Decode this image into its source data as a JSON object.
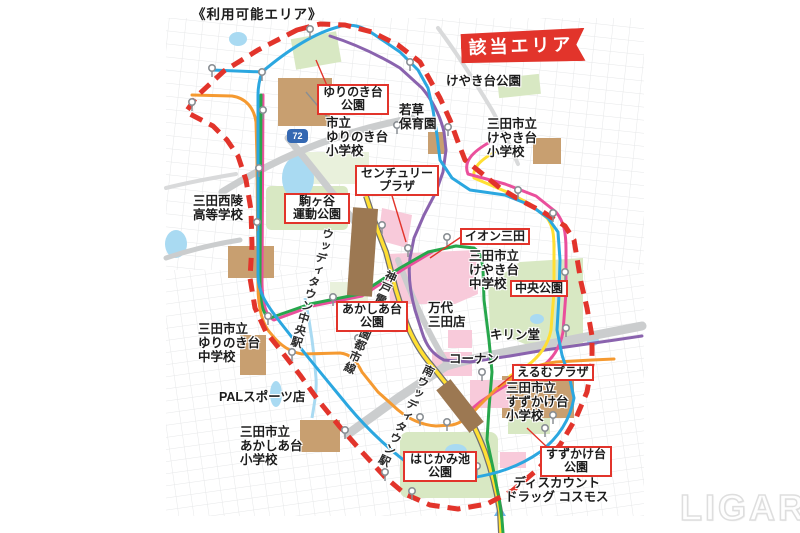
{
  "page": {
    "title": "《利用可能エリア》",
    "banner": "該当エリア",
    "watermark": "LIGARE"
  },
  "map": {
    "road_shield": "72",
    "colors": {
      "red": "#e2342b",
      "blue": "#2ba7e0",
      "green": "#27a74c",
      "orange": "#f59a31",
      "magenta": "#ea4f9c",
      "purple": "#8a63ae",
      "yellow": "#ffdf33",
      "railcase": "#707070",
      "road": "#cbcdce",
      "roadlight": "#d9dadb",
      "park": "#d8e8c3",
      "parkpale": "#e9f1dc",
      "water": "#a9daf2",
      "building": "#c89f70",
      "commercial": "#f8cada",
      "station": "#9c7852",
      "grid": "#e6e7e8"
    },
    "labels": [
      {
        "name": "label-keyakidai-park",
        "text": "けやき台公園",
        "x": 446,
        "y": 74
      },
      {
        "name": "label-wakakusa-nursery",
        "text": "若草\n保育園",
        "x": 399,
        "y": 103
      },
      {
        "name": "label-shiritsu-yurinokidai-elementary",
        "text": "市立\nゆりのき台\n小学校",
        "x": 326,
        "y": 116
      },
      {
        "name": "label-sanda-keyakidai-elementary",
        "text": "三田市立\nけやき台\n小学校",
        "x": 487,
        "y": 117
      },
      {
        "name": "label-sanda-seiryo-highschool",
        "text": "三田西陵\n高等学校",
        "x": 193,
        "y": 194
      },
      {
        "name": "label-sanda-keyakidai-junior-high",
        "text": "三田市立\nけやき台\n中学校",
        "x": 469,
        "y": 249
      },
      {
        "name": "label-mandai-sanda-store",
        "text": "万代\n三田店",
        "x": 428,
        "y": 301
      },
      {
        "name": "label-kirindo",
        "text": "キリン堂",
        "x": 490,
        "y": 328
      },
      {
        "name": "label-kohnan",
        "text": "コーナン",
        "x": 449,
        "y": 352
      },
      {
        "name": "label-sanda-yurinokidai-junior-high",
        "text": "三田市立\nゆりのき台\n中学校",
        "x": 198,
        "y": 322
      },
      {
        "name": "label-pal-sports-store",
        "text": "PALスポーツ店",
        "x": 219,
        "y": 390
      },
      {
        "name": "label-sanda-suzukakedai-elementary",
        "text": "三田市立\nすずかけ台\n小学校",
        "x": 506,
        "y": 381
      },
      {
        "name": "label-sanda-akashiadai-elementary",
        "text": "三田市立\nあかしあ台\n小学校",
        "x": 240,
        "y": 425
      },
      {
        "name": "label-discount-drug-cosmos",
        "text": "ディスカウント\nドラッグ コスモス",
        "x": 505,
        "y": 476,
        "align": "center"
      },
      {
        "name": "label-woodytown-chuo-station",
        "kind": "vert",
        "text": "ウッディタウン中央駅",
        "x": 322,
        "y": 226,
        "rotate": 16,
        "size": 11.5
      },
      {
        "name": "label-kobe-dentetsu-koen-toshi-line",
        "kind": "vert",
        "text": "神戸電鉄公園都市線",
        "x": 386,
        "y": 268,
        "rotate": 24,
        "size": 11.5
      },
      {
        "name": "label-minami-woodytown-station",
        "kind": "vert",
        "text": "南ウッディタウン駅",
        "x": 424,
        "y": 362,
        "rotate": 26,
        "size": 11.5
      },
      {
        "name": "callout-yurinokidai-park",
        "kind": "boxed",
        "text": "ゆりのき台\n公園",
        "x": 317,
        "y": 84,
        "w": 62
      },
      {
        "name": "callout-century-plaza",
        "kind": "boxed",
        "text": "センチュリー\nプラザ",
        "x": 355,
        "y": 165,
        "w": 74
      },
      {
        "name": "callout-komagatani-sports-park",
        "kind": "boxed",
        "text": "駒ヶ谷\n運動公園",
        "x": 284,
        "y": 193,
        "w": 56
      },
      {
        "name": "callout-aeon-sanda",
        "kind": "boxed",
        "text": "イオン三田",
        "x": 460,
        "y": 228
      },
      {
        "name": "callout-chuo-park",
        "kind": "boxed",
        "text": "中央公園",
        "x": 510,
        "y": 280
      },
      {
        "name": "callout-akashiadai-park",
        "kind": "boxed",
        "text": "あかしあ台\n公園",
        "x": 336,
        "y": 301,
        "w": 62
      },
      {
        "name": "callout-elm-plaza",
        "kind": "boxed",
        "text": "えるむプラザ",
        "x": 512,
        "y": 364
      },
      {
        "name": "callout-hajikami-pond-park",
        "kind": "boxed",
        "text": "はじかみ池\n公園",
        "x": 403,
        "y": 451,
        "w": 64
      },
      {
        "name": "callout-suzukakedai-park",
        "kind": "boxed",
        "text": "すずかけ台\n公園",
        "x": 540,
        "y": 446,
        "w": 62
      }
    ]
  }
}
